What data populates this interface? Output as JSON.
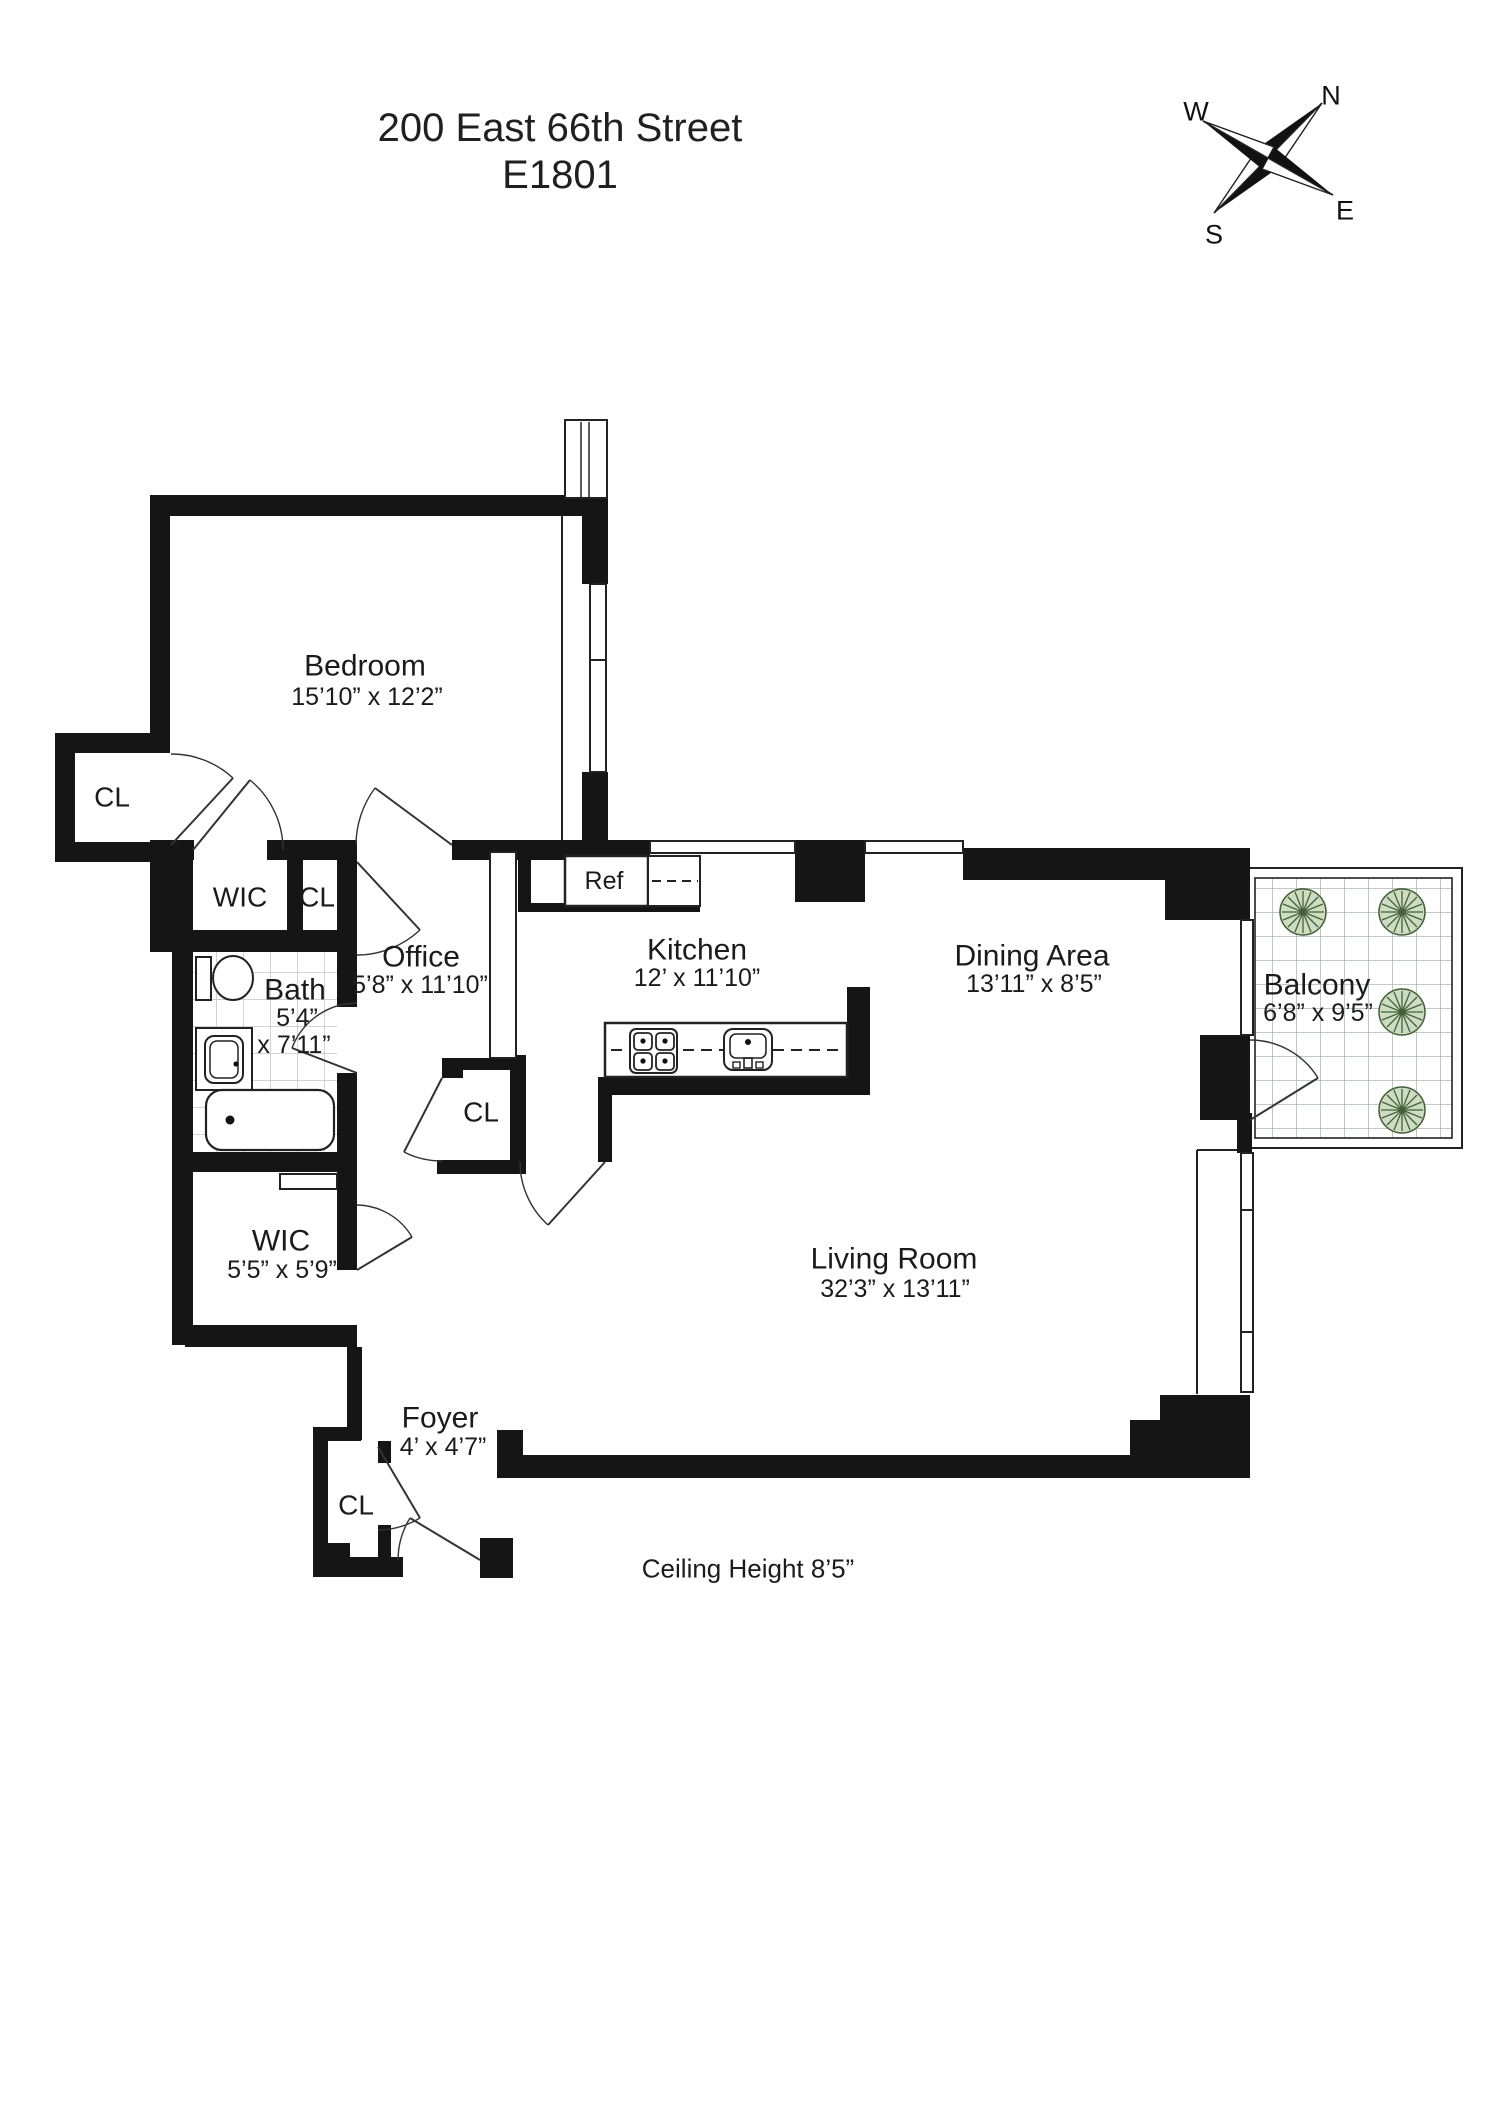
{
  "header": {
    "address": "200 East 66th Street",
    "unit": "E1801"
  },
  "compass": {
    "n": "N",
    "w": "W",
    "s": "S",
    "e": "E"
  },
  "rooms": {
    "bedroom": {
      "name": "Bedroom",
      "dims": "15’10” x 12’2”"
    },
    "closet_top_left": {
      "name": "CL"
    },
    "wic_upper": {
      "name": "WIC"
    },
    "closet_upper": {
      "name": "CL"
    },
    "office": {
      "name": "Office",
      "dims": "5’8” x 11’10”"
    },
    "bath": {
      "name": "Bath",
      "dims_line1": "5’4”",
      "dims_line2": "x 7’11”"
    },
    "kitchen": {
      "name": "Kitchen",
      "dims": "12’ x 11’10”"
    },
    "refrigerator": {
      "name": "Ref"
    },
    "dining": {
      "name": "Dining Area",
      "dims": "13’11” x 8’5”"
    },
    "balcony": {
      "name": "Balcony",
      "dims": "6’8” x 9’5”"
    },
    "closet_kitchen": {
      "name": "CL"
    },
    "wic_lower": {
      "name": "WIC",
      "dims": "5’5” x 5’9”"
    },
    "living": {
      "name": "Living Room",
      "dims": "32’3” x 13’11”"
    },
    "foyer": {
      "name": "Foyer",
      "dims": "4’ x 4’7”"
    },
    "closet_foyer": {
      "name": "CL"
    }
  },
  "notes": {
    "ceiling_height": "Ceiling Height 8’5”"
  },
  "colors": {
    "wall": "#151515",
    "thin_line": "#222222",
    "bath_tile": "#c4c4c4",
    "balcony_tile": "#a0a8a0",
    "plant_fill": "#cdddc2",
    "plant_stroke": "#43603a"
  }
}
